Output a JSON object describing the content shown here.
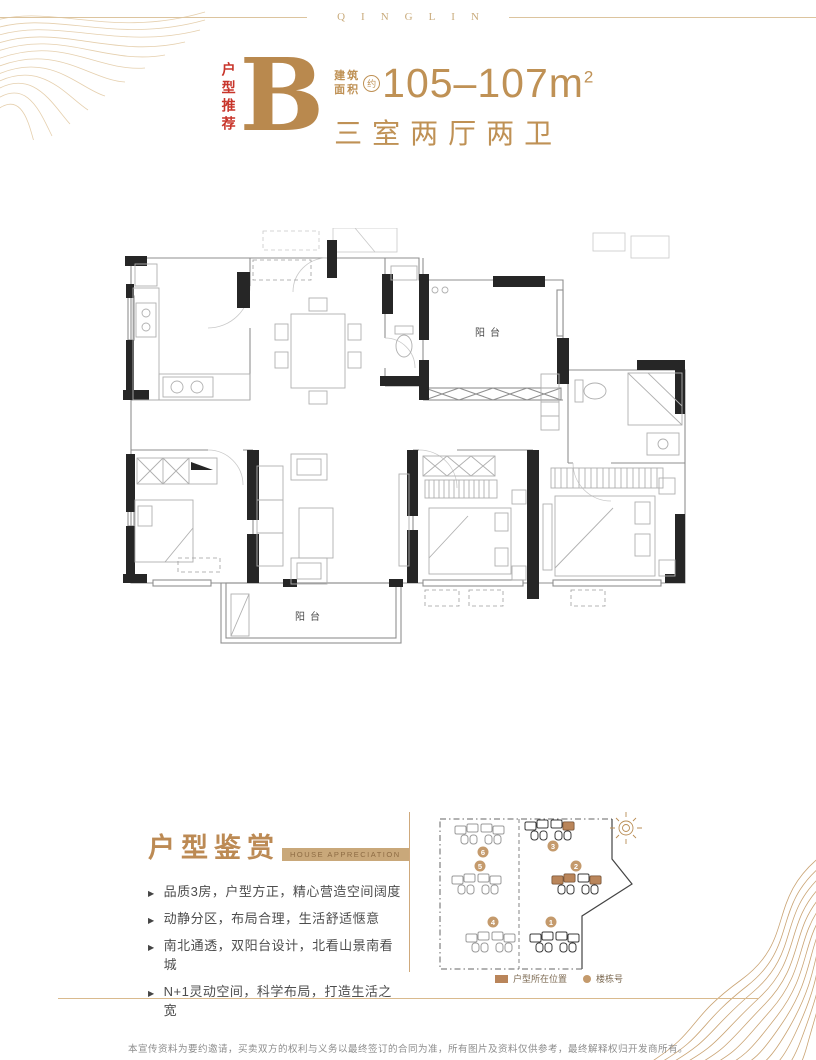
{
  "brand": {
    "name": "QINGLIN"
  },
  "header": {
    "tag": "户型推荐",
    "unit_letter": "B",
    "area_label_top": "建筑",
    "area_label_bottom": "面积",
    "area_approx": "约",
    "area_value": "105–107m",
    "area_superscript": "2",
    "layout_summary": "三室两厅两卫"
  },
  "floorplan": {
    "label_balcony_north": "阳台",
    "label_balcony_south": "阳台"
  },
  "appreciation": {
    "title": "户型鉴赏",
    "subtitle": "HOUSE APPRECIATION",
    "bullet_marker": "▶",
    "bullets": [
      "品质3房，户型方正，精心营造空间阔度",
      "动静分区，布局合理，生活舒适惬意",
      "南北通透，双阳台设计，北看山景南看城",
      "N+1灵动空间，科学布局，打造生活之宽"
    ]
  },
  "siteplan": {
    "buildings": [
      {
        "num": "1",
        "highlighted": false
      },
      {
        "num": "2",
        "highlighted": true
      },
      {
        "num": "3",
        "highlighted": true
      },
      {
        "num": "4",
        "highlighted": false
      },
      {
        "num": "5",
        "highlighted": false
      },
      {
        "num": "6",
        "highlighted": false
      }
    ],
    "legend": {
      "unit_location": "户型所在位置",
      "building_number": "楼栋号"
    }
  },
  "footer": {
    "disclaimer": "本宣传资料为要约邀请，买卖双方的权利与义务以最终签订的合同为准，所有图片及资料仅供参考，最终解释权归开发商所有。"
  },
  "colors": {
    "gold": "#bf9155",
    "red": "#c8352b",
    "tan_highlight": "#b9855a",
    "brand_tan": "#c9ab7c"
  }
}
